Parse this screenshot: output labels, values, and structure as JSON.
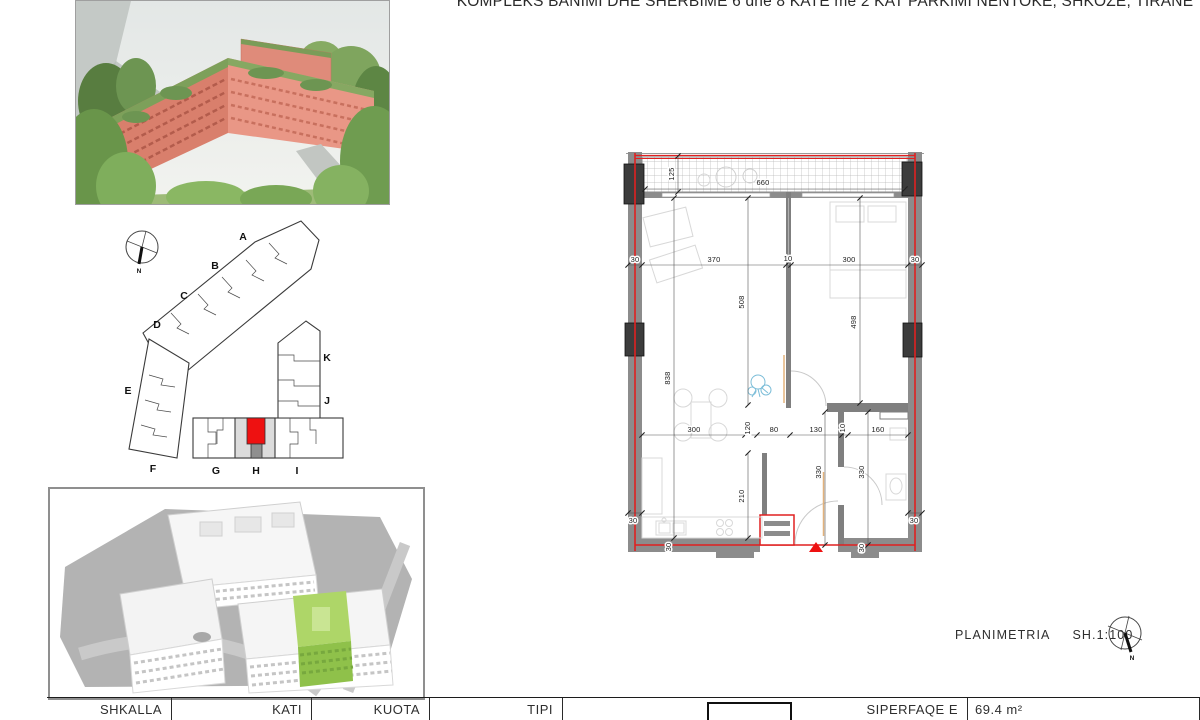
{
  "sheet": {
    "title": "KOMPLEKS BANIMI DHE SHERBIME 6 dhe 8 KATE me 2 KAT PARKIMI NENTOKE, SHKOZE, TIRANE"
  },
  "site_plan": {
    "sections": [
      "A",
      "B",
      "C",
      "D",
      "E",
      "F",
      "G",
      "H",
      "I",
      "J",
      "K"
    ],
    "north_label": "N",
    "highlight_color": "#ee1111",
    "shaded_section": "H"
  },
  "floor_plan": {
    "wall_color": "#8c8c8c",
    "accent_color": "#e02020",
    "dimensions": {
      "balcony_depth": "125",
      "balcony_width": "660",
      "top_row": [
        "30",
        "370",
        "10",
        "300",
        "30"
      ],
      "living_depth": "508",
      "bedroom_depth": "498",
      "left_side_depth": "838",
      "lower_row": [
        "300",
        "120",
        "80",
        "130",
        "10",
        "160"
      ],
      "kitchen_depth": "210",
      "hall_depth": "330",
      "bath_depth": "330",
      "corner_bottom_left": "30",
      "corner_bottom_left_side": "30",
      "corner_bottom_right": "30",
      "corner_bottom_right_side": "30"
    }
  },
  "model_view": {
    "highlight_color": "#9ccc55"
  },
  "caption": {
    "label": "PLANIMETRIA",
    "scale": "SH.1:100",
    "north_label": "N"
  },
  "footer": {
    "columns": [
      "SHKALLA",
      "KATI",
      "KUOTA",
      "TIPI"
    ],
    "area_label": "SIPERFAQE E APARTAMENTIT",
    "area_value": "69.4 m²"
  }
}
